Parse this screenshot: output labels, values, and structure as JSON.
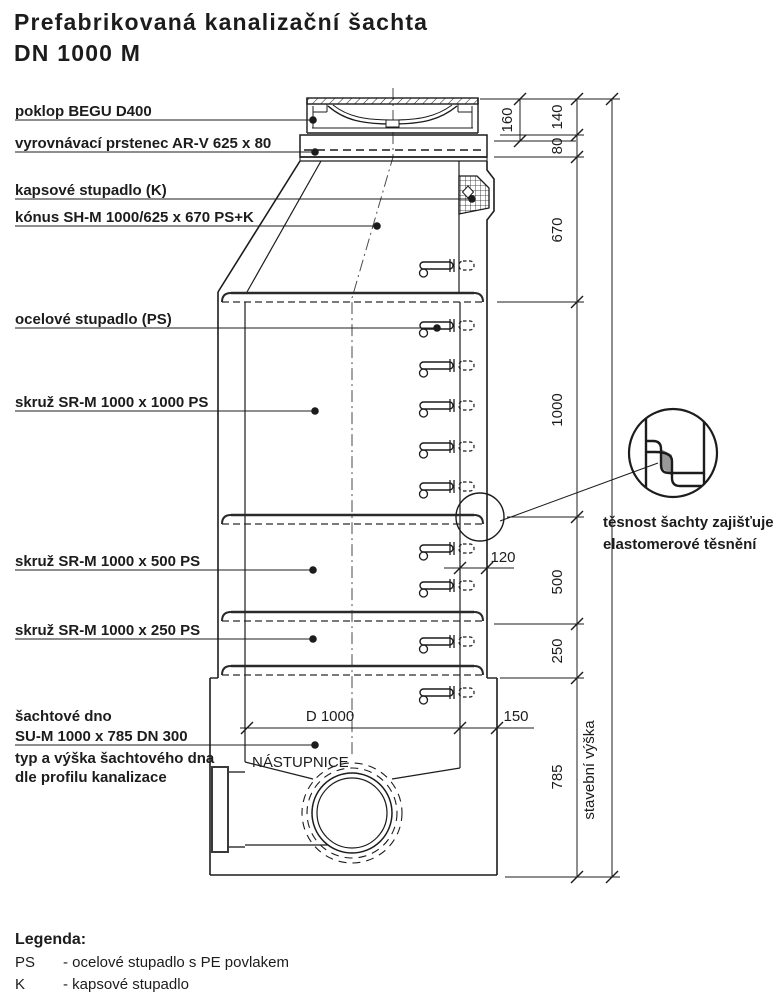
{
  "title": {
    "line1": "Prefabrikovaná kanalizační šachta",
    "line2": "DN 1000 M"
  },
  "part_labels": [
    {
      "text": "poklop BEGU D400"
    },
    {
      "text": "vyrovnávací prstenec AR-V 625 x 80"
    },
    {
      "text": "kapsové stupadlo (K)"
    },
    {
      "text": "kónus SH-M 1000/625 x 670 PS+K"
    },
    {
      "text": "ocelové stupadlo (PS)"
    },
    {
      "text": "skruž SR-M 1000 x 1000 PS"
    },
    {
      "text": "skruž SR-M 1000 x 500 PS"
    },
    {
      "text": "skruž SR-M 1000 x 250 PS"
    }
  ],
  "base_label": {
    "line1": "šachtové dno",
    "line2": "SU-M 1000 x 785 DN 300",
    "note1": "typ a výška šachtového dna",
    "note2": "dle profilu kanalizace"
  },
  "drawing_texts": {
    "nastupnice": "NÁSTUPNICE",
    "d1000": "D 1000",
    "dim_150": "150",
    "dim_120": "120"
  },
  "dimensions": {
    "cover_inner": "160",
    "cover": "140",
    "ring_ar": "80",
    "cone": "670",
    "ring_1000": "1000",
    "ring_500": "500",
    "ring_250": "250",
    "base": "785",
    "overall_label": "stavební výška"
  },
  "detail_note": {
    "line1": "těsnost šachty zajišťuje",
    "line2": "elastomerové těsnění"
  },
  "legend": {
    "heading": "Legenda:",
    "items": [
      {
        "key": "PS",
        "desc": "- ocelové stupadlo s PE povlakem"
      },
      {
        "key": "K",
        "desc": "- kapsové stupadlo"
      }
    ]
  },
  "colors": {
    "line": "#1c1c1c",
    "gasket": "#999999",
    "background": "#ffffff"
  }
}
